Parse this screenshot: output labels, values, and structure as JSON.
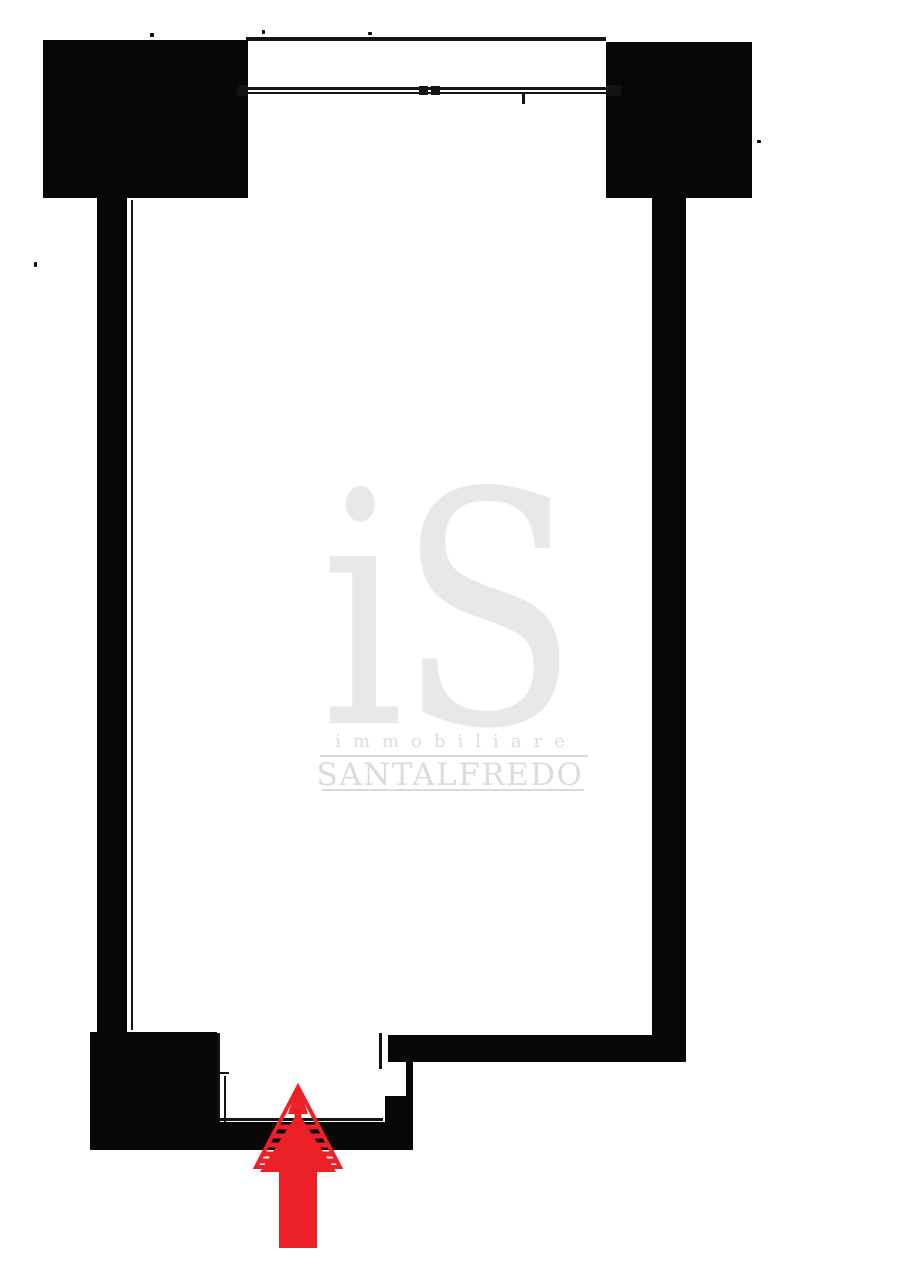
{
  "watermark": {
    "logo_text": "iS",
    "tagline": "immobiliare",
    "brand": "SANTALFREDO"
  },
  "icons": {
    "entrance_arrow": "thick-up-arrow"
  },
  "colors": {
    "wall_black": "#070707",
    "line_black": "#141414",
    "paper_white": "#ffffff",
    "watermark_gray": "#e8e8e8",
    "watermark_text_gray": "#dcdcdc",
    "rule_gray": "#d9d9d9",
    "arrow_red": "#ec2027"
  }
}
